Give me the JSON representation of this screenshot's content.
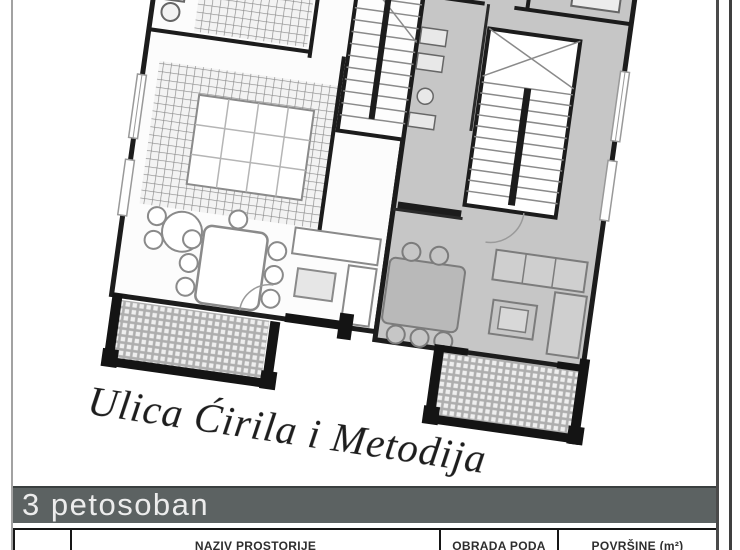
{
  "page": {
    "street_label": "Ulica Ćirila i Metodija",
    "unit_banner": "3 petosoban"
  },
  "table": {
    "columns": [
      {
        "label": ""
      },
      {
        "label": "NAZIV PROSTORIJE"
      },
      {
        "label": "OBRADA PODA"
      },
      {
        "label": "POVRŠINE (m²)"
      }
    ]
  },
  "colors": {
    "banner_background": "#5c6262",
    "banner_text": "#ececec",
    "highlighted_unit_fill": "#c6c6c6",
    "walls": "#1c1c1c"
  }
}
